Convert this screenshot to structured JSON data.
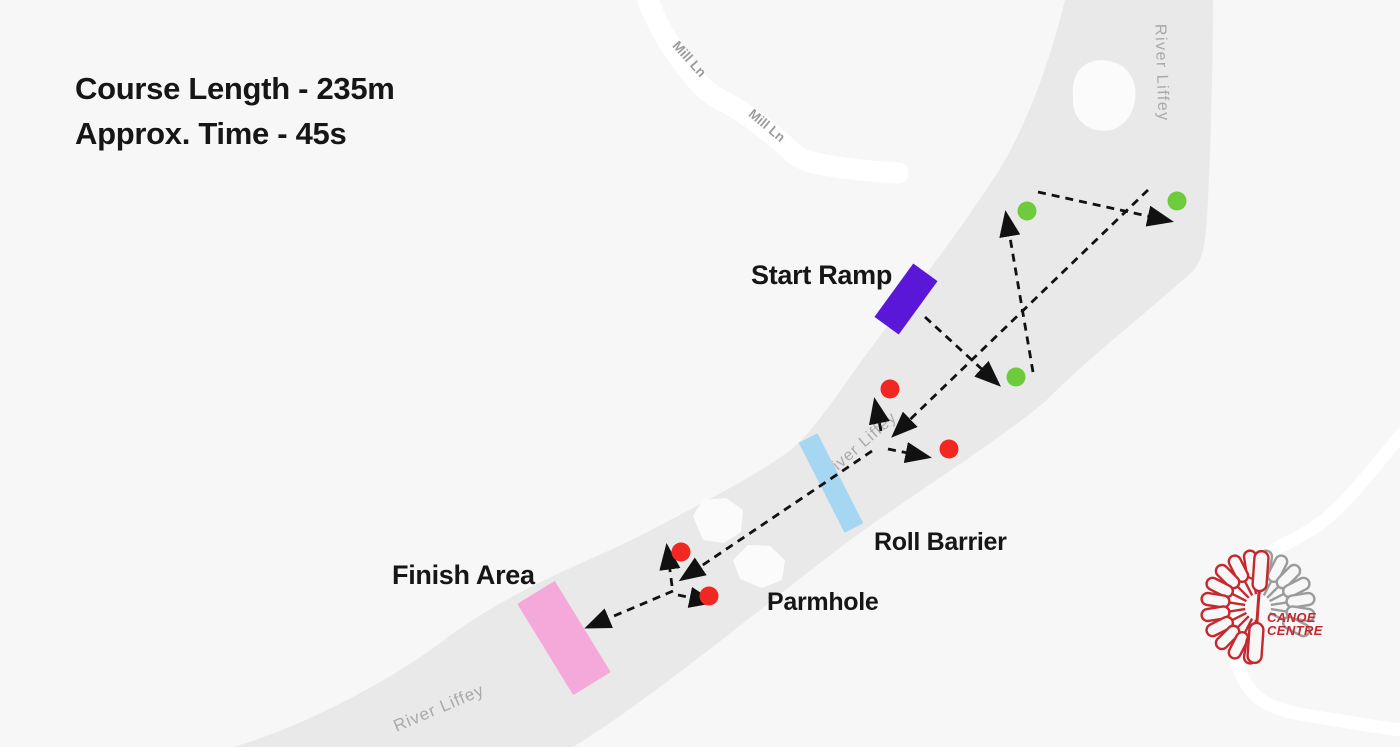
{
  "info": {
    "course_length": "Course Length - 235m",
    "approx_time": "Approx. Time - 45s"
  },
  "labels": {
    "start_ramp": "Start Ramp",
    "roll_barrier": "Roll Barrier",
    "finish_area": "Finish Area",
    "parmhole": "Parmhole"
  },
  "map_labels": {
    "mill_ln_upper": "Mill Ln",
    "mill_ln_lower": "Mill Ln",
    "river_liffey_top": "River Liffey",
    "river_liffey_mid": "River Liffey",
    "river_liffey_bottom": "River Liffey"
  },
  "logo": {
    "name_line1": "CANOE",
    "name_line2": "CENTRE"
  },
  "colors": {
    "background": "#f7f7f7",
    "river": "#e9e9e9",
    "road": "#ffffff",
    "start_ramp": "#5a17d8",
    "roll_barrier": "#a5d6f2",
    "finish_area": "#f5a8da",
    "gate_green": "#6ecb3c",
    "gate_red": "#f02722",
    "arrow": "#111111",
    "map_label": "#9c9c9c",
    "river_label": "#a9a9a9",
    "label_text": "#161616",
    "logo_red": "#c5282d",
    "logo_gray": "#9b9b9b"
  },
  "course": {
    "gate_radius": 9.5,
    "green_gates": [
      {
        "x": 1027,
        "y": 211
      },
      {
        "x": 1177,
        "y": 201
      },
      {
        "x": 1016,
        "y": 377
      }
    ],
    "red_gates": [
      {
        "x": 890,
        "y": 389
      },
      {
        "x": 949,
        "y": 449
      },
      {
        "x": 681,
        "y": 552
      },
      {
        "x": 709,
        "y": 596
      }
    ],
    "arrows": [
      {
        "name": "arrow-start-to-green3",
        "x1": 925,
        "y1": 317,
        "x2": 998,
        "y2": 384
      },
      {
        "name": "arrow-green3-to-green1",
        "x1": 1033,
        "y1": 372,
        "x2": 1006,
        "y2": 214
      },
      {
        "name": "arrow-green1-to-green2",
        "x1": 1038,
        "y1": 192,
        "x2": 1170,
        "y2": 221
      },
      {
        "name": "arrow-green2-to-junction1",
        "x1": 1148,
        "y1": 190,
        "x2": 894,
        "y2": 435
      },
      {
        "name": "arrow-junction1-up",
        "x1": 881,
        "y1": 431,
        "x2": 875,
        "y2": 401
      },
      {
        "name": "arrow-junction1-right",
        "x1": 888,
        "y1": 449,
        "x2": 928,
        "y2": 457
      },
      {
        "name": "arrow-junction1-to-junction2",
        "x1": 872,
        "y1": 451,
        "x2": 682,
        "y2": 579
      },
      {
        "name": "arrow-junction2-up",
        "x1": 672,
        "y1": 586,
        "x2": 667,
        "y2": 547
      },
      {
        "name": "arrow-junction2-right",
        "x1": 678,
        "y1": 595,
        "x2": 712,
        "y2": 602
      },
      {
        "name": "arrow-junction2-to-finish",
        "x1": 673,
        "y1": 591,
        "x2": 588,
        "y2": 627
      }
    ]
  }
}
